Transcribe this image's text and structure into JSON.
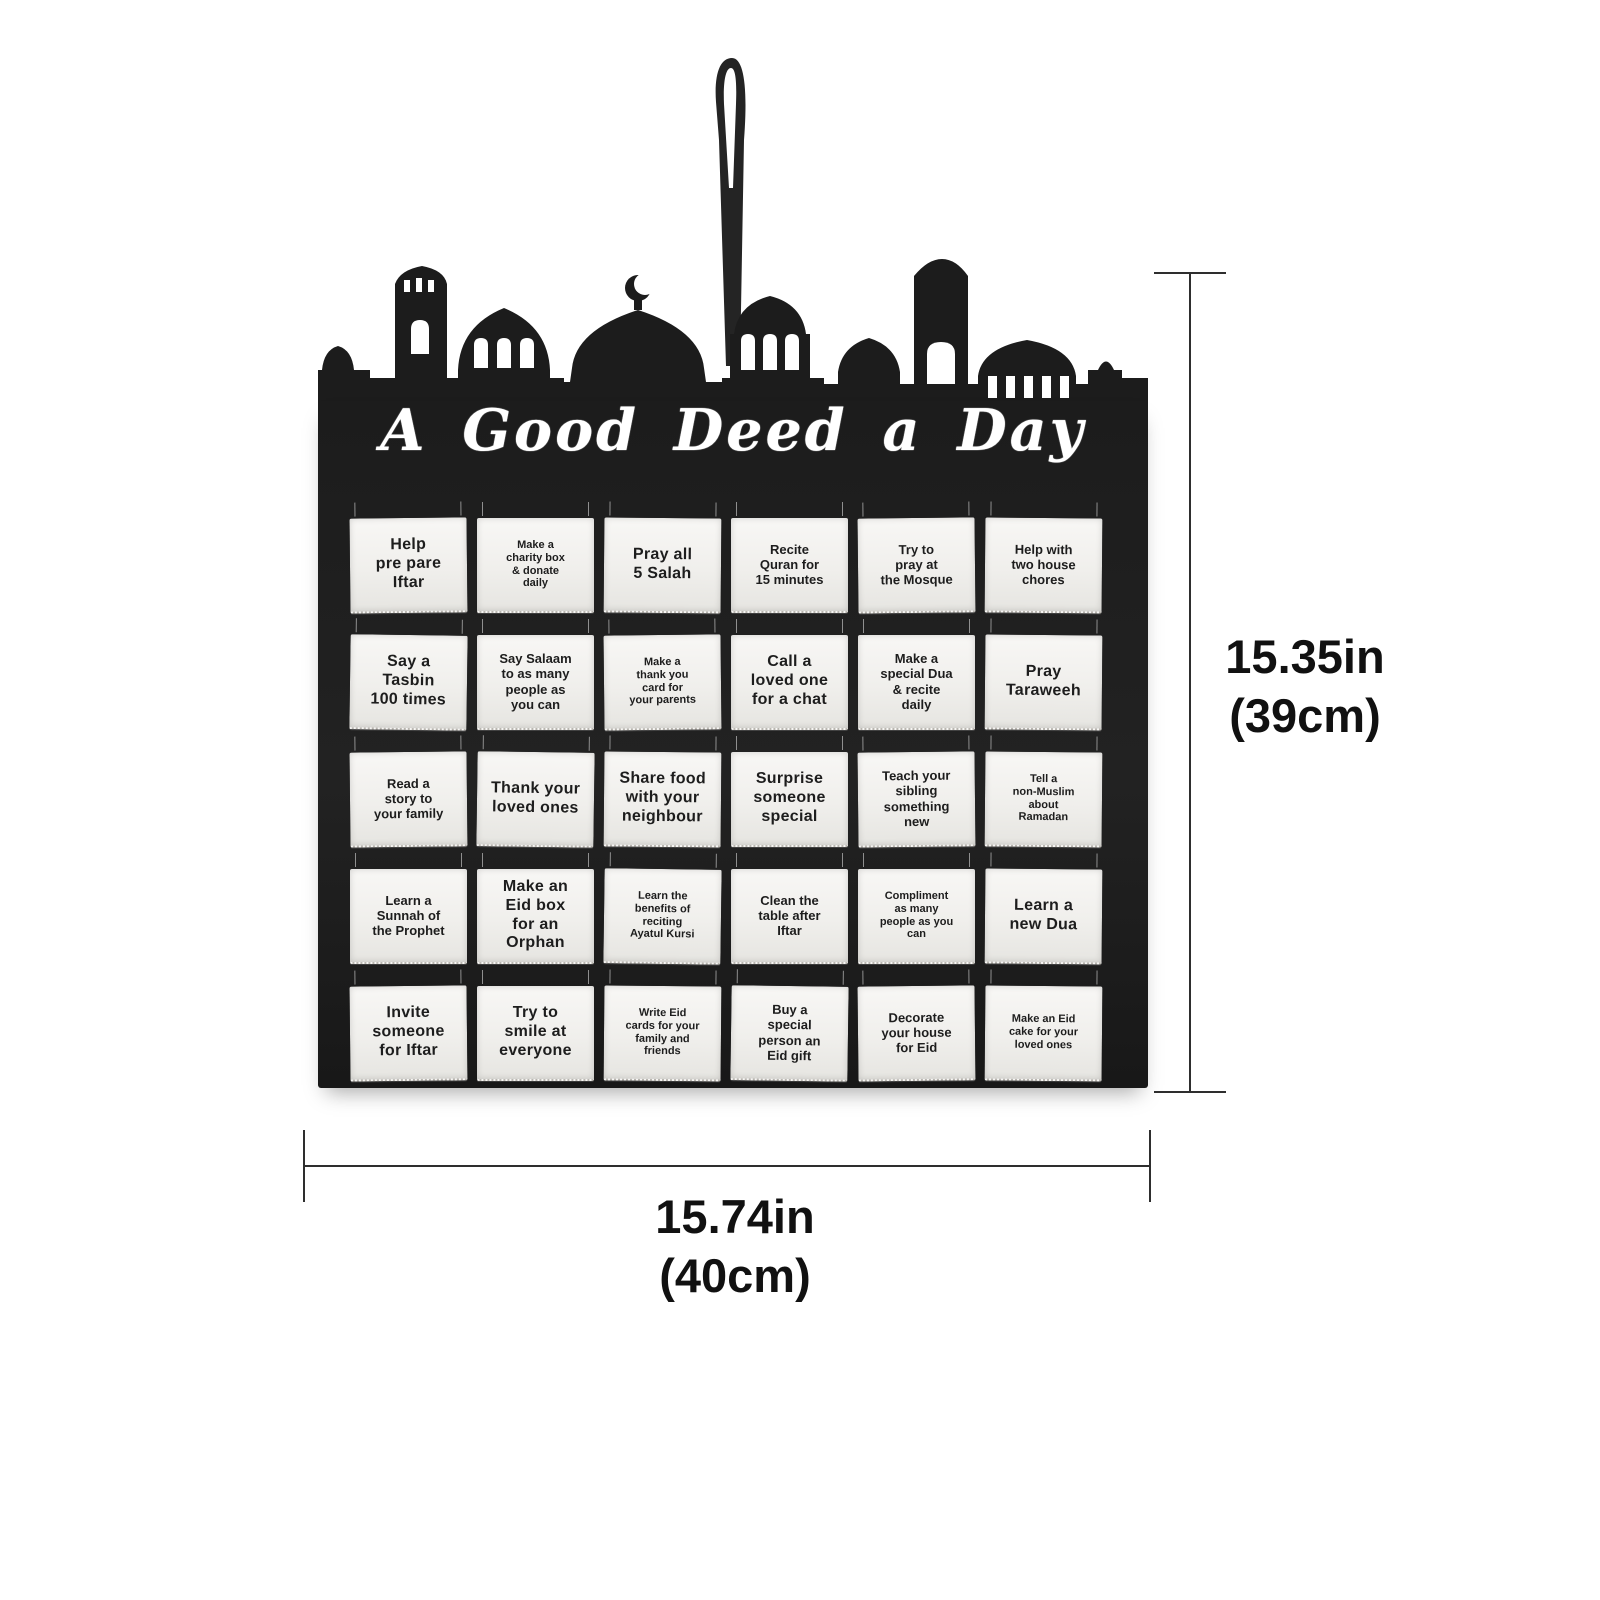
{
  "product": {
    "title": "A Good Deed a Day",
    "pockets": [
      {
        "text": "Help\npre pare\nIftar",
        "size": "lg"
      },
      {
        "text": "Make a\ncharity box\n& donate\ndaily",
        "size": "sm"
      },
      {
        "text": "Pray all\n5 Salah",
        "size": "lg"
      },
      {
        "text": "Recite\nQuran for\n15 minutes",
        "size": "md"
      },
      {
        "text": "Try to\npray at\nthe Mosque",
        "size": "md"
      },
      {
        "text": "Help with\ntwo house\nchores",
        "size": "md"
      },
      {
        "text": "Say a\nTasbin\n100 times",
        "size": "lg"
      },
      {
        "text": "Say Salaam\nto as many\npeople as\nyou can",
        "size": "md"
      },
      {
        "text": "Make a\nthank you\ncard for\nyour parents",
        "size": "sm"
      },
      {
        "text": "Call a\nloved one\nfor a chat",
        "size": "lg"
      },
      {
        "text": "Make a\nspecial Dua\n& recite\ndaily",
        "size": "md"
      },
      {
        "text": "Pray\nTaraweeh",
        "size": "lg"
      },
      {
        "text": "Read a\nstory to\nyour family",
        "size": "md"
      },
      {
        "text": "Thank your\nloved ones",
        "size": "lg"
      },
      {
        "text": "Share food\nwith your\nneighbour",
        "size": "lg"
      },
      {
        "text": "Surprise\nsomeone\nspecial",
        "size": "lg"
      },
      {
        "text": "Teach your\nsibling\nsomething\nnew",
        "size": "md"
      },
      {
        "text": "Tell a\nnon-Muslim\nabout\nRamadan",
        "size": "sm"
      },
      {
        "text": "Learn a\nSunnah of\nthe Prophet",
        "size": "md"
      },
      {
        "text": "Make an\nEid box\nfor an\nOrphan",
        "size": "lg"
      },
      {
        "text": "Learn the\nbenefits of\nreciting\nAyatul Kursi",
        "size": "sm"
      },
      {
        "text": "Clean the\ntable after\nIftar",
        "size": "md"
      },
      {
        "text": "Compliment\nas many\npeople as you\ncan",
        "size": "sm"
      },
      {
        "text": "Learn a\nnew Dua",
        "size": "lg"
      },
      {
        "text": "Invite\nsomeone\nfor Iftar",
        "size": "lg"
      },
      {
        "text": "Try to\nsmile at\neveryone",
        "size": "lg"
      },
      {
        "text": "Write Eid\ncards for your\nfamily and\nfriends",
        "size": "sm"
      },
      {
        "text": "Buy a\nspecial\nperson an\nEid gift",
        "size": "md"
      },
      {
        "text": "Decorate\nyour house\nfor Eid",
        "size": "md"
      },
      {
        "text": "Make an Eid\ncake for your\nloved ones",
        "size": "sm"
      }
    ]
  },
  "dimensions": {
    "height_in": "15.35in",
    "height_cm": "(39cm)",
    "width_in": "15.74in",
    "width_cm": "(40cm)"
  },
  "colors": {
    "calendar_black": "#1c1c1c",
    "pocket_white": "#f0efec",
    "dimension_text": "#111111",
    "background": "#ffffff"
  },
  "icons": {
    "hanging_loop": "hanging-loop",
    "mosque_skyline": "mosque-skyline-silhouette",
    "crescent": "crescent-moon-finial"
  }
}
